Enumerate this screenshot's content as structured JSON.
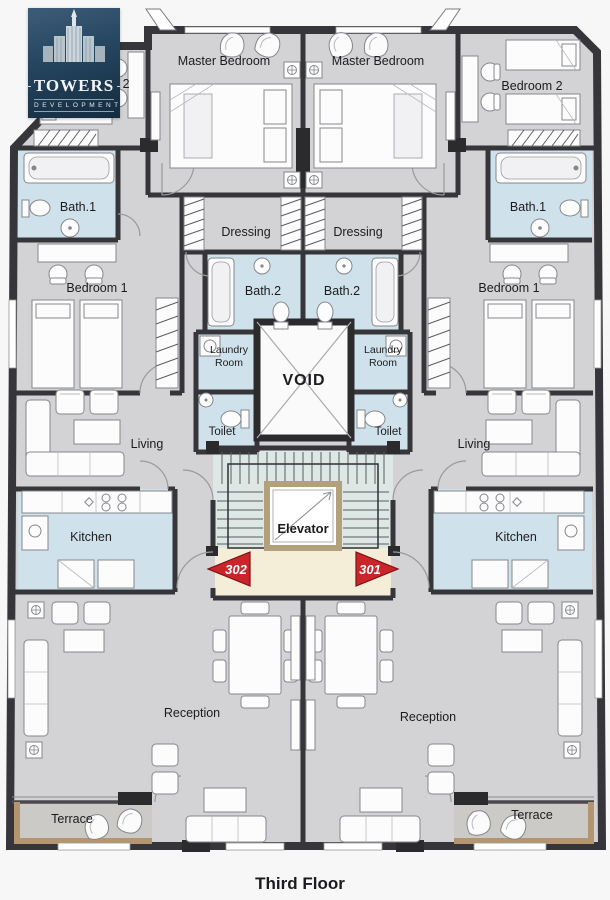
{
  "page": {
    "title": "Third Floor"
  },
  "logo": {
    "brand": "TOWERS",
    "tagline": "DEVELOPMENT"
  },
  "units": {
    "left": {
      "number": "302"
    },
    "right": {
      "number": "301"
    }
  },
  "rooms": {
    "master_bedroom_left": {
      "label": "Master Bedroom"
    },
    "master_bedroom_right": {
      "label": "Master Bedroom"
    },
    "bedroom2_left": {
      "label": "Bedroom 2"
    },
    "bedroom2_right": {
      "label": "Bedroom 2"
    },
    "bath1_left": {
      "label": "Bath.1"
    },
    "bath1_right": {
      "label": "Bath.1"
    },
    "dressing_left": {
      "label": "Dressing"
    },
    "dressing_right": {
      "label": "Dressing"
    },
    "bath2_left": {
      "label": "Bath.2"
    },
    "bath2_right": {
      "label": "Bath.2"
    },
    "bedroom1_left": {
      "label": "Bedroom 1"
    },
    "bedroom1_right": {
      "label": "Bedroom 1"
    },
    "laundry_left": {
      "label": "Laundry Room",
      "line1": "Laundry",
      "line2": "Room"
    },
    "laundry_right": {
      "label": "Laundry Room",
      "line1": "Laundry",
      "line2": "Room"
    },
    "void": {
      "label": "VOID"
    },
    "toilet_left": {
      "label": "Toilet"
    },
    "toilet_right": {
      "label": "Toilet"
    },
    "living_left": {
      "label": "Living"
    },
    "living_right": {
      "label": "Living"
    },
    "kitchen_left": {
      "label": "Kitchen"
    },
    "kitchen_right": {
      "label": "Kitchen"
    },
    "elevator": {
      "label": "Elevator"
    },
    "reception_left": {
      "label": "Reception"
    },
    "reception_right": {
      "label": "Reception"
    },
    "terrace_left": {
      "label": "Terrace"
    },
    "terrace_right": {
      "label": "Terrace"
    }
  },
  "colors": {
    "floor": "#d3d3d5",
    "wall": "#36363a",
    "wet_room": "#cfe1ea",
    "stairs": "#dde8e4",
    "lobby": "#f4eed8",
    "elevator_frame": "#b3a07c",
    "arrow_red": "#c9252b",
    "logo_navy": "#1c3145",
    "terrace_trim": "#b5956f"
  }
}
